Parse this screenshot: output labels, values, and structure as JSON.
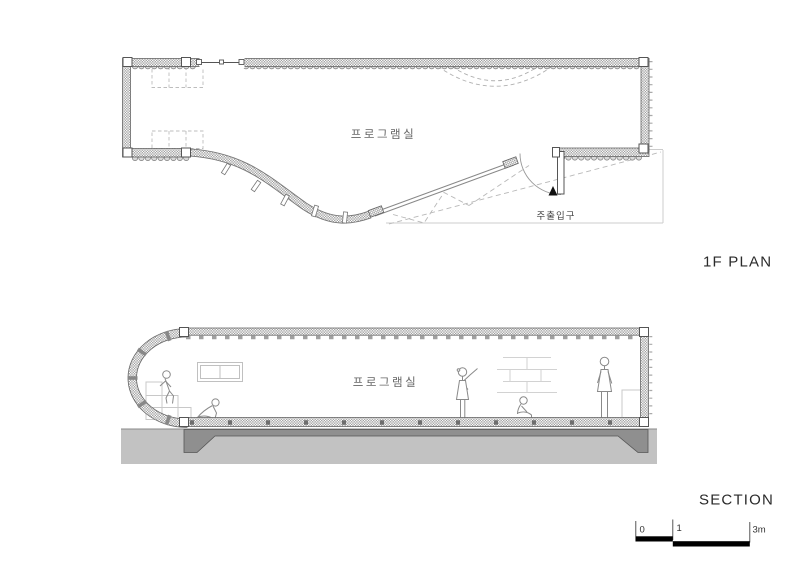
{
  "drawing": {
    "plan": {
      "title": "1F PLAN",
      "room_label": "프로그램실",
      "entrance_label": "주출입구"
    },
    "section": {
      "title": "SECTION",
      "room_label": "프로그램실"
    },
    "scale_bar": {
      "tick_start": "0",
      "tick_mid": "1",
      "tick_end": "3m"
    },
    "colors": {
      "line_dark": "#555555",
      "wall_hatch": "#9f9f9f",
      "ground": "#c2c2c2",
      "slab": "#8f8f8f",
      "light_line": "#c8c8c8",
      "dashed_line": "#b8b8b8",
      "figure_line": "#8a8a8a",
      "text_dark": "#2a2a2a"
    }
  }
}
